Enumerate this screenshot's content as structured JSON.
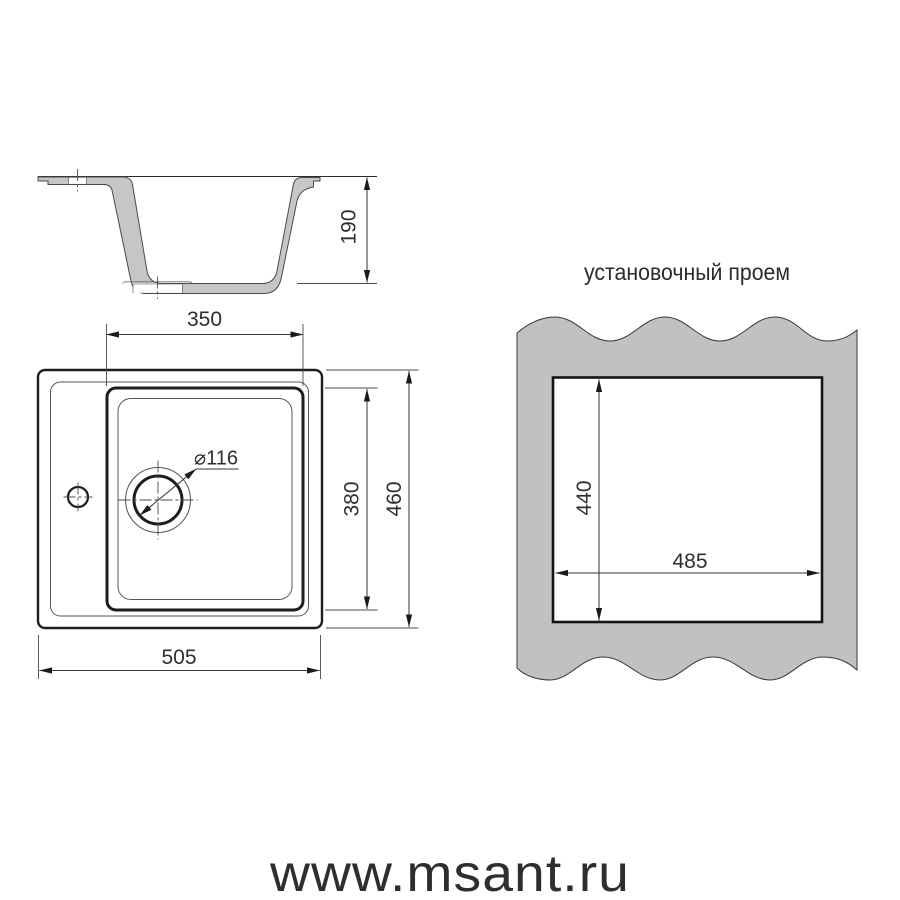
{
  "section_view": {
    "depth_dim": "190"
  },
  "plan_view": {
    "bowl_width_dim": "350",
    "drain_diameter_dim": "⌀116",
    "bowl_length_dim": "380",
    "outer_length_dim": "460",
    "outer_width_dim": "505"
  },
  "opening_view": {
    "title": "установочный проем",
    "height_dim": "440",
    "width_dim": "485"
  },
  "watermark": "www.msant.ru",
  "colors": {
    "section_fill": "#c6c6c6",
    "panel_fill": "#c1c1c1",
    "watermark": "#ededed"
  }
}
